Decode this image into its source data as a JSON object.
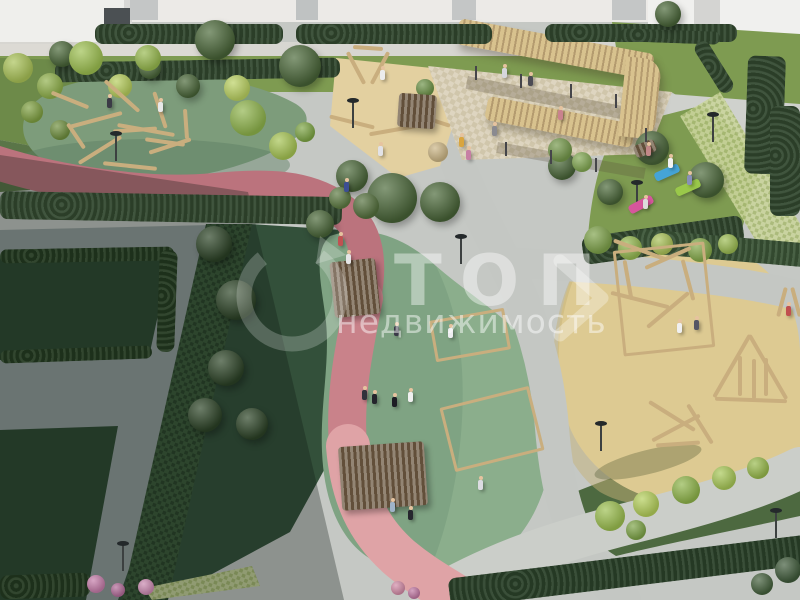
{
  "watermark": {
    "title": "ТОП",
    "subtitle": "недвижимость",
    "logo": "circular-arrow-icon",
    "mark": "chevron-mark-icon"
  },
  "palette": {
    "building": "#efefec",
    "buildingShade": "#d6d6d3",
    "doorDark": "#4b5053",
    "walkway": "#d7d6d1",
    "pathGray": "#c4c7c3",
    "plaza": "#929c9c",
    "lawn": "#7e9b51",
    "lawnDark": "#5a7548",
    "lawnShadow": "#2d4832",
    "hedge": "#32482f",
    "hedgeDark": "#22381f",
    "bushLime": "#9cbf50",
    "trackShade": "#bb737d",
    "trackMid": "#c9828a",
    "trackLight": "#dfa3a6",
    "rubberGreen": "#7d9c7b",
    "rubberGreenSun": "#93b592",
    "rubberTeal": "#7fa383",
    "rubberYellow": "#ddca92",
    "sand": "#e3d0a0",
    "wood": "#c9ae7e",
    "woodLight": "#d8c28e",
    "woodShade": "#b49b6f",
    "terrace": "#ded5c0",
    "matBlue": "#45a4d6",
    "matGreen": "#9ac84a",
    "matPink": "#d6569c",
    "flowerPink": "#c47ba8",
    "watermarkWhite": "#ffffff"
  },
  "scene": {
    "hedges": [
      {
        "x": 95,
        "y": 24,
        "w": 188,
        "h": 20,
        "r": 0
      },
      {
        "x": 296,
        "y": 24,
        "w": 196,
        "h": 20,
        "r": 0
      },
      {
        "x": 545,
        "y": 24,
        "w": 192,
        "h": 18,
        "r": 0
      },
      {
        "x": 55,
        "y": 60,
        "w": 285,
        "h": 20,
        "r": -1
      },
      {
        "x": 620,
        "y": 30,
        "w": 100,
        "h": 13,
        "r": 2
      },
      {
        "x": 706,
        "y": 38,
        "w": 16,
        "h": 58,
        "r": -32
      },
      {
        "x": 746,
        "y": 56,
        "w": 38,
        "h": 118,
        "r": 2
      },
      {
        "x": 770,
        "y": 106,
        "w": 30,
        "h": 110,
        "r": 0
      },
      {
        "x": 0,
        "y": 194,
        "w": 342,
        "h": 28,
        "r": 1
      },
      {
        "x": 0,
        "y": 248,
        "w": 174,
        "h": 14,
        "r": -1,
        "c": "#22381f"
      },
      {
        "x": 158,
        "y": 250,
        "w": 18,
        "h": 102,
        "r": 2,
        "c": "#22381f"
      },
      {
        "x": 0,
        "y": 348,
        "w": 152,
        "h": 13,
        "r": -2,
        "c": "#22381f"
      },
      {
        "x": 0,
        "y": 574,
        "w": 90,
        "h": 24,
        "r": -2,
        "c": "#22381f"
      },
      {
        "x": 582,
        "y": 226,
        "w": 162,
        "h": 28,
        "r": -8
      },
      {
        "x": 636,
        "y": 236,
        "w": 172,
        "h": 24,
        "r": 5,
        "c": "#3b5537"
      },
      {
        "x": 448,
        "y": 556,
        "w": 370,
        "h": 30,
        "r": -7,
        "c": "#2b422a"
      }
    ],
    "trees": [
      {
        "x": 215,
        "y": 40,
        "r": 20
      },
      {
        "x": 300,
        "y": 66,
        "r": 21
      },
      {
        "x": 62,
        "y": 54,
        "r": 13
      },
      {
        "x": 150,
        "y": 68,
        "r": 11
      },
      {
        "x": 188,
        "y": 86,
        "r": 12
      },
      {
        "x": 668,
        "y": 14,
        "r": 13
      },
      {
        "x": 352,
        "y": 176,
        "r": 16
      },
      {
        "x": 392,
        "y": 198,
        "r": 25
      },
      {
        "x": 440,
        "y": 202,
        "r": 20
      },
      {
        "x": 320,
        "y": 224,
        "r": 14
      },
      {
        "x": 562,
        "y": 166,
        "r": 14
      },
      {
        "x": 652,
        "y": 148,
        "r": 17
      },
      {
        "x": 706,
        "y": 180,
        "r": 18
      },
      {
        "x": 610,
        "y": 192,
        "r": 13
      },
      {
        "x": 214,
        "y": 244,
        "r": 18,
        "dark": true
      },
      {
        "x": 236,
        "y": 300,
        "r": 20,
        "dark": true
      },
      {
        "x": 226,
        "y": 368,
        "r": 18,
        "dark": true
      },
      {
        "x": 252,
        "y": 424,
        "r": 16,
        "dark": true
      },
      {
        "x": 205,
        "y": 415,
        "r": 17,
        "dark": true
      }
    ],
    "bushes": [
      {
        "x": 18,
        "y": 68,
        "r": 15,
        "c": "#a9c257"
      },
      {
        "x": 50,
        "y": 86,
        "r": 13,
        "c": "#8fb04a"
      },
      {
        "x": 86,
        "y": 58,
        "r": 17,
        "c": "#9dc050"
      },
      {
        "x": 120,
        "y": 86,
        "r": 12,
        "c": "#b6cd5c"
      },
      {
        "x": 32,
        "y": 112,
        "r": 11,
        "c": "#7fa041"
      },
      {
        "x": 148,
        "y": 58,
        "r": 13,
        "c": "#97b94e"
      },
      {
        "x": 60,
        "y": 130,
        "r": 10,
        "c": "#6f8f3e"
      },
      {
        "x": 248,
        "y": 118,
        "r": 18,
        "c": "#8fb44c"
      },
      {
        "x": 283,
        "y": 146,
        "r": 14,
        "c": "#a6c453"
      },
      {
        "x": 237,
        "y": 88,
        "r": 13,
        "c": "#bad161"
      },
      {
        "x": 305,
        "y": 132,
        "r": 10,
        "c": "#7da544"
      },
      {
        "x": 366,
        "y": 206,
        "r": 13,
        "c": "#54703d"
      },
      {
        "x": 340,
        "y": 198,
        "r": 11,
        "c": "#5d7a42"
      },
      {
        "x": 598,
        "y": 240,
        "r": 14,
        "c": "#7ea24a"
      },
      {
        "x": 630,
        "y": 248,
        "r": 12,
        "c": "#94b850"
      },
      {
        "x": 662,
        "y": 244,
        "r": 11,
        "c": "#a9c157"
      },
      {
        "x": 700,
        "y": 250,
        "r": 12,
        "c": "#86ab4b"
      },
      {
        "x": 728,
        "y": 244,
        "r": 10,
        "c": "#9cbc52"
      },
      {
        "x": 610,
        "y": 516,
        "r": 15,
        "c": "#9cbf50"
      },
      {
        "x": 646,
        "y": 504,
        "r": 13,
        "c": "#b4cf5a"
      },
      {
        "x": 686,
        "y": 490,
        "r": 14,
        "c": "#8fb54a"
      },
      {
        "x": 724,
        "y": 478,
        "r": 12,
        "c": "#a8c857"
      },
      {
        "x": 758,
        "y": 468,
        "r": 11,
        "c": "#98ba4c"
      },
      {
        "x": 636,
        "y": 530,
        "r": 10,
        "c": "#7da447"
      },
      {
        "x": 560,
        "y": 150,
        "r": 12,
        "c": "#74984a"
      },
      {
        "x": 582,
        "y": 162,
        "r": 10,
        "c": "#82a852"
      },
      {
        "x": 425,
        "y": 88,
        "r": 9,
        "c": "#6d9348"
      },
      {
        "x": 438,
        "y": 152,
        "r": 10,
        "c": "#cbb584"
      },
      {
        "x": 96,
        "y": 584,
        "r": 9,
        "c": "#c47ba8"
      },
      {
        "x": 118,
        "y": 590,
        "r": 7,
        "c": "#b06a97"
      },
      {
        "x": 146,
        "y": 587,
        "r": 8,
        "c": "#c988af"
      },
      {
        "x": 398,
        "y": 588,
        "r": 7,
        "c": "#d28ba6"
      },
      {
        "x": 414,
        "y": 593,
        "r": 6,
        "c": "#c077a2"
      },
      {
        "x": 788,
        "y": 570,
        "r": 13,
        "c": "#3f5a3a"
      },
      {
        "x": 762,
        "y": 584,
        "r": 11,
        "c": "#44603c"
      }
    ],
    "logs": [
      {
        "x": 70,
        "y": 100,
        "l": 40,
        "r": 22
      },
      {
        "x": 95,
        "y": 120,
        "l": 55,
        "r": -15
      },
      {
        "x": 122,
        "y": 96,
        "l": 46,
        "r": 42
      },
      {
        "x": 146,
        "y": 130,
        "l": 58,
        "r": 10
      },
      {
        "x": 100,
        "y": 150,
        "l": 50,
        "r": -32
      },
      {
        "x": 160,
        "y": 110,
        "l": 38,
        "r": 72
      },
      {
        "x": 76,
        "y": 136,
        "l": 30,
        "r": 56
      },
      {
        "x": 170,
        "y": 146,
        "l": 44,
        "r": -18
      },
      {
        "x": 130,
        "y": 166,
        "l": 54,
        "r": 6
      },
      {
        "x": 186,
        "y": 124,
        "l": 30,
        "r": 86
      },
      {
        "x": 135,
        "y": 130,
        "l": 44,
        "r": -4
      },
      {
        "x": 165,
        "y": 142,
        "l": 40,
        "r": 8
      },
      {
        "x": 352,
        "y": 122,
        "l": 46,
        "r": 14
      },
      {
        "x": 394,
        "y": 130,
        "l": 50,
        "r": -10
      },
      {
        "x": 432,
        "y": 120,
        "l": 38,
        "r": 18
      },
      {
        "x": 356,
        "y": 68,
        "l": 36,
        "r": 62
      },
      {
        "x": 380,
        "y": 68,
        "l": 36,
        "r": -62
      },
      {
        "x": 368,
        "y": 48,
        "l": 30,
        "r": 4
      },
      {
        "x": 732,
        "y": 366,
        "l": 72,
        "r": -60
      },
      {
        "x": 768,
        "y": 367,
        "l": 74,
        "r": 60
      },
      {
        "x": 751,
        "y": 400,
        "l": 72,
        "r": 2
      },
      {
        "x": 740,
        "y": 376,
        "l": 40,
        "r": 90
      },
      {
        "x": 754,
        "y": 379,
        "l": 40,
        "r": 90
      },
      {
        "x": 766,
        "y": 377,
        "l": 38,
        "r": 90
      },
      {
        "x": 672,
        "y": 416,
        "l": 54,
        "r": 32
      },
      {
        "x": 676,
        "y": 428,
        "l": 54,
        "r": -28
      },
      {
        "x": 700,
        "y": 424,
        "l": 46,
        "r": 58
      },
      {
        "x": 678,
        "y": 444,
        "l": 44,
        "r": -4
      },
      {
        "x": 640,
        "y": 250,
        "l": 56,
        "r": 20
      },
      {
        "x": 668,
        "y": 258,
        "l": 50,
        "r": -24
      },
      {
        "x": 640,
        "y": 300,
        "l": 60,
        "r": 14
      },
      {
        "x": 668,
        "y": 310,
        "l": 54,
        "r": -40
      },
      {
        "x": 628,
        "y": 280,
        "l": 40,
        "r": 80
      },
      {
        "x": 688,
        "y": 280,
        "l": 42,
        "r": 75
      },
      {
        "x": 782,
        "y": 302,
        "l": 30,
        "r": -75
      },
      {
        "x": 796,
        "y": 302,
        "l": 30,
        "r": 75
      }
    ],
    "frames": [
      {
        "x": 432,
        "y": 314,
        "w": 70,
        "h": 36,
        "r": -10
      },
      {
        "x": 446,
        "y": 396,
        "w": 86,
        "h": 60,
        "r": -14
      },
      {
        "x": 618,
        "y": 246,
        "w": 86,
        "h": 100,
        "r": -6
      }
    ],
    "benches": [
      {
        "x": 332,
        "y": 260,
        "w": 46,
        "h": 56,
        "r": -6
      },
      {
        "x": 340,
        "y": 444,
        "w": 86,
        "h": 64,
        "r": -4
      },
      {
        "x": 398,
        "y": 94,
        "w": 38,
        "h": 34,
        "r": 4
      },
      {
        "x": 634,
        "y": 142,
        "w": 22,
        "h": 13,
        "r": -22
      }
    ],
    "posts": [
      {
        "x": 475,
        "y": 66
      },
      {
        "x": 520,
        "y": 74
      },
      {
        "x": 570,
        "y": 84
      },
      {
        "x": 615,
        "y": 94
      },
      {
        "x": 505,
        "y": 142
      },
      {
        "x": 550,
        "y": 150
      },
      {
        "x": 595,
        "y": 158
      },
      {
        "x": 645,
        "y": 128
      }
    ],
    "lamps": [
      {
        "x": 115,
        "y": 135
      },
      {
        "x": 352,
        "y": 102
      },
      {
        "x": 460,
        "y": 238
      },
      {
        "x": 600,
        "y": 425
      },
      {
        "x": 712,
        "y": 116
      },
      {
        "x": 636,
        "y": 184
      },
      {
        "x": 775,
        "y": 512
      },
      {
        "x": 122,
        "y": 545
      }
    ],
    "mats": [
      {
        "x": 667,
        "y": 172,
        "c": "#45a4d6",
        "r": -24
      },
      {
        "x": 688,
        "y": 187,
        "c": "#9ac84a",
        "r": -24
      },
      {
        "x": 641,
        "y": 204,
        "c": "#d6569c",
        "r": -28
      }
    ],
    "people": [
      {
        "x": 107,
        "y": 98,
        "c": "#3b3b46"
      },
      {
        "x": 158,
        "y": 102,
        "c": "#e8e8e8"
      },
      {
        "x": 338,
        "y": 236,
        "c": "#c05252"
      },
      {
        "x": 346,
        "y": 254,
        "c": "#e6e6e6"
      },
      {
        "x": 380,
        "y": 70,
        "c": "#ececec"
      },
      {
        "x": 378,
        "y": 146,
        "c": "#e2e2e6"
      },
      {
        "x": 459,
        "y": 137,
        "c": "#d9a53f"
      },
      {
        "x": 466,
        "y": 150,
        "c": "#c77fa4"
      },
      {
        "x": 502,
        "y": 68,
        "c": "#d6d6dc"
      },
      {
        "x": 528,
        "y": 76,
        "c": "#4c4c55"
      },
      {
        "x": 558,
        "y": 110,
        "c": "#c9828e"
      },
      {
        "x": 492,
        "y": 126,
        "c": "#8a8a90"
      },
      {
        "x": 362,
        "y": 390,
        "c": "#32323c"
      },
      {
        "x": 372,
        "y": 394,
        "c": "#24242c"
      },
      {
        "x": 392,
        "y": 397,
        "c": "#1d1d24"
      },
      {
        "x": 408,
        "y": 392,
        "c": "#f0f0f0"
      },
      {
        "x": 448,
        "y": 328,
        "c": "#ededf0"
      },
      {
        "x": 394,
        "y": 326,
        "c": "#3a3a48"
      },
      {
        "x": 478,
        "y": 480,
        "c": "#dcdce2"
      },
      {
        "x": 390,
        "y": 502,
        "c": "#9fb3c8"
      },
      {
        "x": 344,
        "y": 182,
        "c": "#3c4e92"
      },
      {
        "x": 668,
        "y": 158,
        "c": "#f2f2f2"
      },
      {
        "x": 687,
        "y": 175,
        "c": "#8890b8"
      },
      {
        "x": 643,
        "y": 199,
        "c": "#dcdcdc"
      },
      {
        "x": 646,
        "y": 146,
        "c": "#c28888"
      },
      {
        "x": 677,
        "y": 323,
        "c": "#f0f0f0"
      },
      {
        "x": 694,
        "y": 320,
        "c": "#565664"
      },
      {
        "x": 786,
        "y": 306,
        "c": "#c04f4f"
      },
      {
        "x": 408,
        "y": 510,
        "c": "#26262e"
      }
    ]
  }
}
